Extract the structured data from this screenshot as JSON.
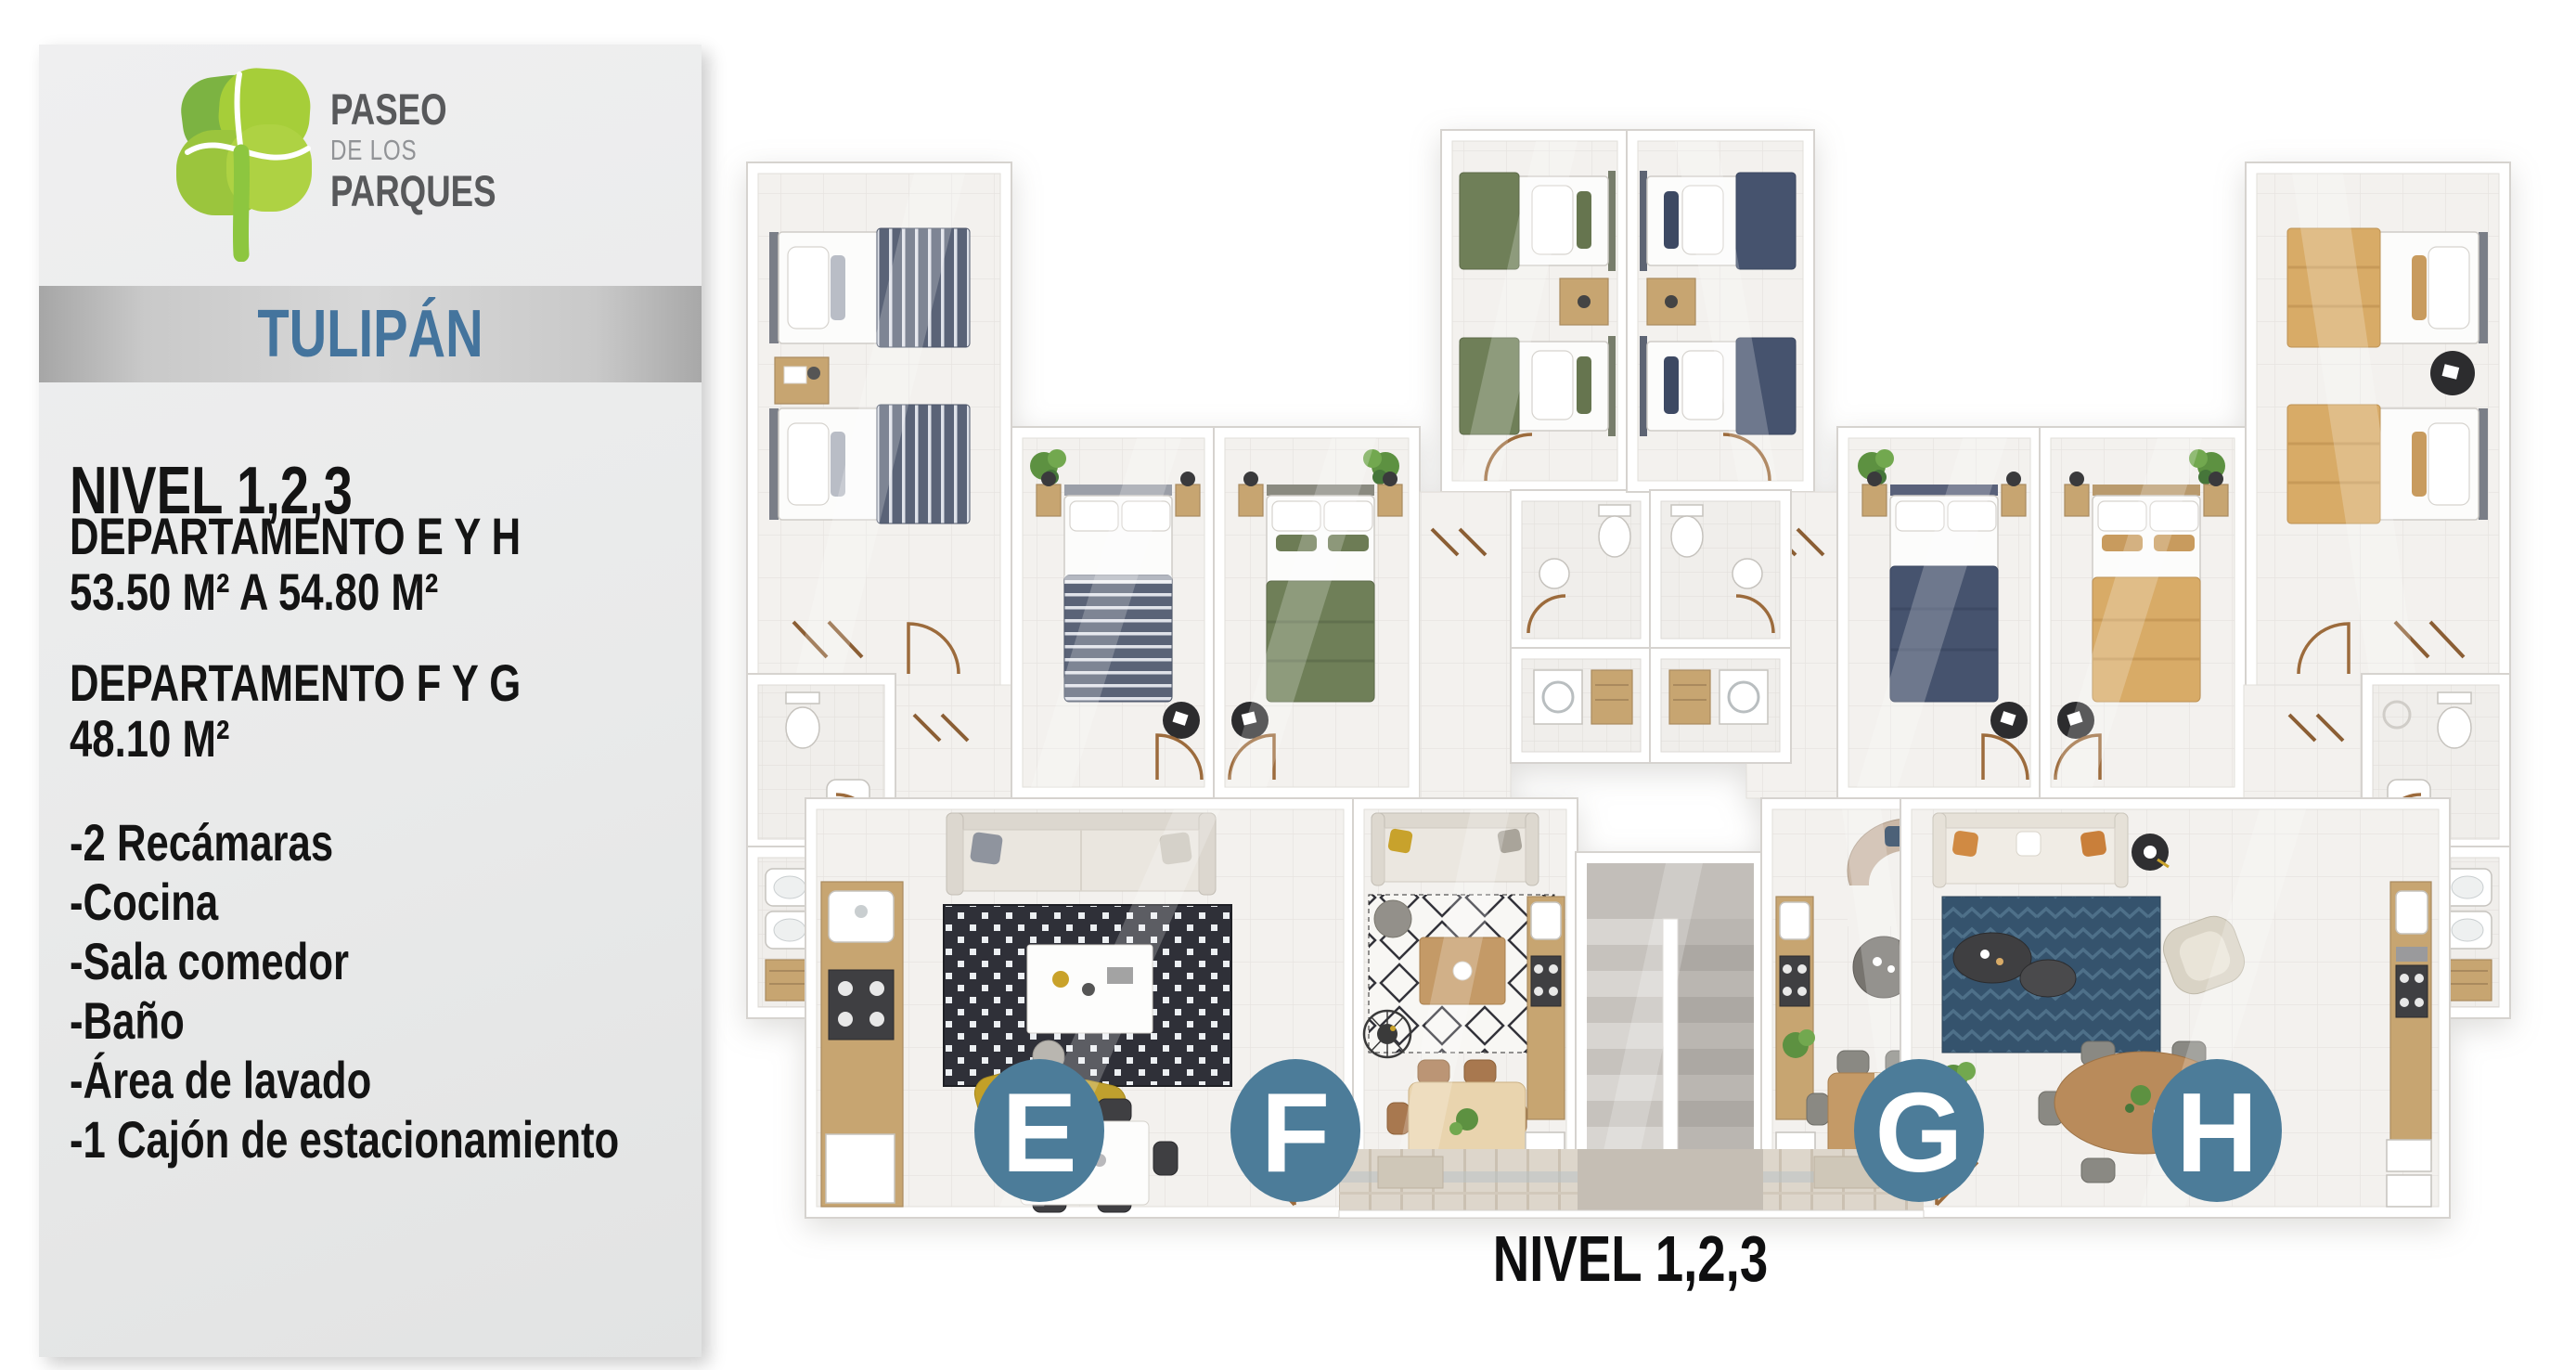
{
  "brand": {
    "line1": "PASEO",
    "line2": "DE LOS",
    "line3": "PARQUES",
    "colors": {
      "leaf_dark": "#7CB342",
      "leaf_light": "#A6CE39",
      "trunk": "#8DC63F",
      "text_dark": "#58595B",
      "text_light": "#919396"
    }
  },
  "sidebar": {
    "building_name": "TULIPÁN",
    "level_title": "NIVEL 1,2,3",
    "specs": [
      {
        "title": "DEPARTAMENTO E Y H",
        "area": "53.50 M² A 54.80 M²"
      },
      {
        "title": "DEPARTAMENTO F Y G",
        "area": "48.10 M²"
      }
    ],
    "features": [
      "-2 Recámaras",
      "-Cocina",
      "-Sala comedor",
      "-Baño",
      "-Área de lavado",
      "-1 Cajón de estacionamiento"
    ],
    "accent_blue": "#44749D",
    "panel_gray": "#E9EAEA"
  },
  "plan": {
    "caption": "NIVEL 1,2,3",
    "badge_color": "#4C7C99",
    "units": [
      {
        "id": "E"
      },
      {
        "id": "F"
      },
      {
        "id": "G"
      },
      {
        "id": "H"
      }
    ],
    "colors": {
      "bedding_e": "#5A6377",
      "bedding_f": "#6F7F58",
      "bedding_g": "#46536E",
      "bedding_h": "#D8AB67"
    }
  }
}
